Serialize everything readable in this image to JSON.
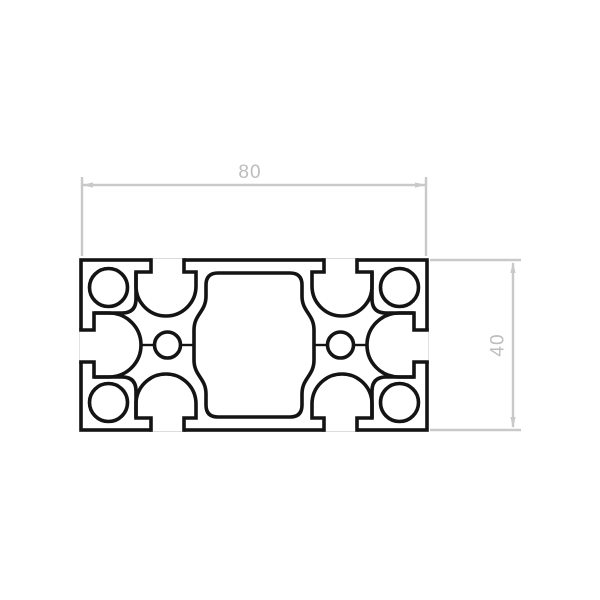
{
  "drawing": {
    "title": "aluminum-extrusion-profile-cross-section",
    "dimensions": {
      "width": {
        "label": "80"
      },
      "height": {
        "label": "40"
      }
    },
    "colors": {
      "outline": "#141414",
      "dimension_line": "#c9c9c9",
      "dimension_text": "#bdbdbd",
      "background": "#ffffff"
    }
  }
}
